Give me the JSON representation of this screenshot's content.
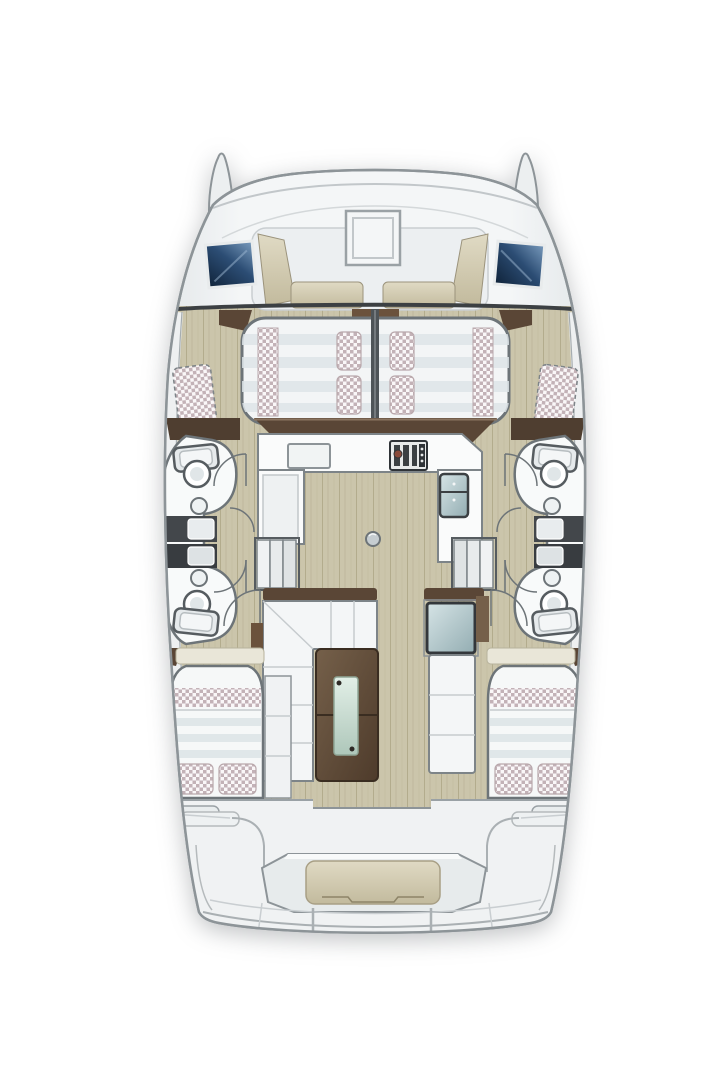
{
  "plan": {
    "type": "catamaran-yacht-deck-and-accommodation-plan",
    "orientation": "bow-up",
    "foredeck": {
      "hatches": 1,
      "windows": 2,
      "lounge_cushions": 4
    },
    "forward_berths": {
      "count": 2,
      "pillows": 4,
      "checkered_runners": 2
    },
    "heads": {
      "count": 2,
      "toilets": 4,
      "sinks": 4,
      "shower_boxes": 4
    },
    "galley": {
      "sink": 1,
      "cooktop": 1,
      "refrigerator": 1
    },
    "stairways": 2,
    "salon": {
      "sofa": "L-shaped",
      "table": "wood-with-glass-inlay",
      "nav_glass_table": 1
    },
    "aft_cabins": {
      "count": 2,
      "pillows": 4,
      "checkered_bands": 2
    },
    "aft_deck": {
      "bench_cushion": 1,
      "transom_panels": 2
    }
  },
  "colors": {
    "page_bg": "#ffffff",
    "hull_fill": "#f0f2f3",
    "hull_stroke": "#8d9498",
    "panel_line": "#b7bdc0",
    "dark_trim": "#3c4043",
    "floor_tan": "#cbc5ab",
    "floor_grain": "#a89f82",
    "cushion_tan_light": "#e0dac4",
    "cushion_tan_dark": "#c2ba9d",
    "wood_dark": "#5a4636",
    "wood_mid": "#75604a",
    "wood_table_light": "#75604a",
    "wood_table_deep": "#4e3b2b",
    "window_navy_deep": "#0f2238",
    "window_navy": "#2c4d74",
    "window_navy_light": "#7a9cbe",
    "mattress_white": "#f5f7f8",
    "mattress_stripe": "#dde4e7",
    "check_pink": "#c3b2b7",
    "check_bg": "#faf7f8",
    "counter_white": "#fafbfb",
    "counter_stroke": "#7d8488",
    "shower_dark": "#43474b",
    "shower_dark2": "#383c40",
    "fixture_stroke": "#565c60",
    "glass_green_light": "#e2efe7",
    "glass_green_dark": "#aec7ba",
    "glass_blue_light": "#d6e4e6",
    "glass_blue_dark": "#93adb2",
    "steel": "#c6cdd1"
  }
}
